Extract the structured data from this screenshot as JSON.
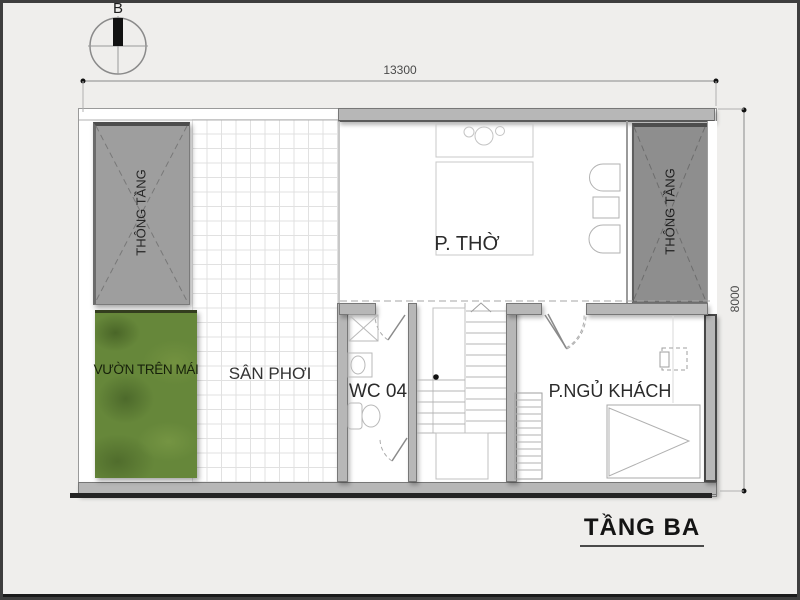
{
  "drawing": {
    "title": "TẦNG BA",
    "compass_label": "B",
    "dim_width": "13300",
    "dim_height": "8000"
  },
  "rooms": {
    "void_left": "THÔNG TẦNG",
    "void_right": "THÔNG TẦNG",
    "roof_garden": "VƯỜN TRÊN MÁI",
    "drying_yard": "SÂN PHƠI",
    "worship_room": "P. THỜ",
    "wc": "WC 04",
    "guest_bedroom": "P.NGỦ KHÁCH"
  },
  "colors": {
    "background": "#efeeec",
    "frame_border": "#3e3e3e",
    "wall": "#b7b7b7",
    "void_left_fill": "#9e9e9e",
    "void_right_fill": "#8e8e8e",
    "garden_green": "#66873a",
    "ink": "#2e2e2e"
  }
}
